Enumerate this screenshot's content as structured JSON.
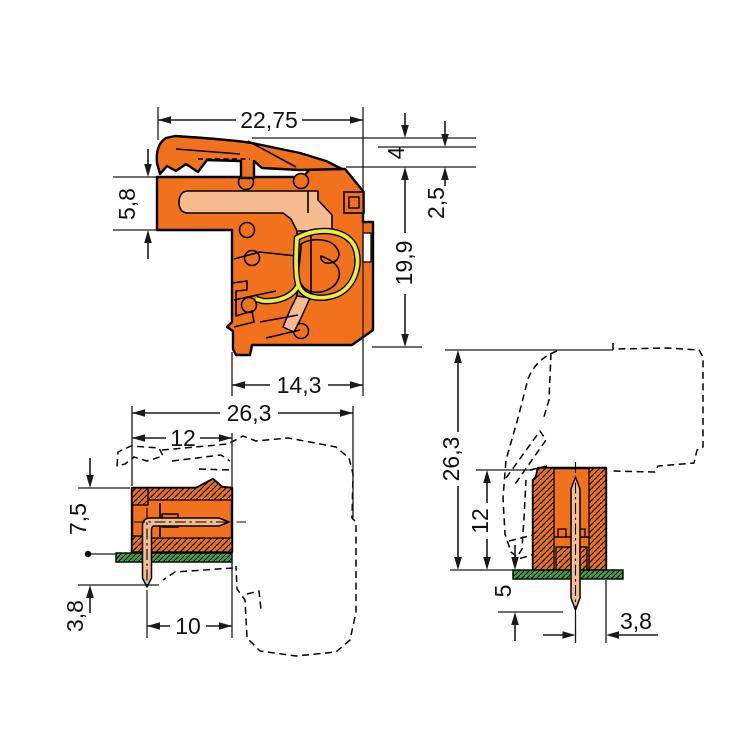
{
  "drawing": {
    "kind": "dimensioned-connector-drawing",
    "views": {
      "side": {
        "dims": {
          "width_top": "22,75",
          "latch_height": "4",
          "upper_body_height": "5,8",
          "latch_offset": "2,5",
          "body_height": "19,9",
          "width_bottom": "14,3"
        }
      },
      "header_side": {
        "dims": {
          "total_depth": "26,3",
          "header_depth": "12",
          "header_height": "7,5",
          "pin_protrusion": "3,8",
          "pin_center_to_face": "10"
        }
      },
      "header_front": {
        "dims": {
          "total_height": "26,3",
          "header_height": "12",
          "pin_below_board": "5",
          "pin_center_to_edge": "3,8"
        }
      }
    },
    "colors": {
      "housing_orange": "#F2711C",
      "contact_copper": "#F6BC8F",
      "spring_yellow_green": "#E6EE3E",
      "pcb_green": "#3FA845",
      "line_black": "#111111",
      "background": "#FFFFFF"
    }
  }
}
